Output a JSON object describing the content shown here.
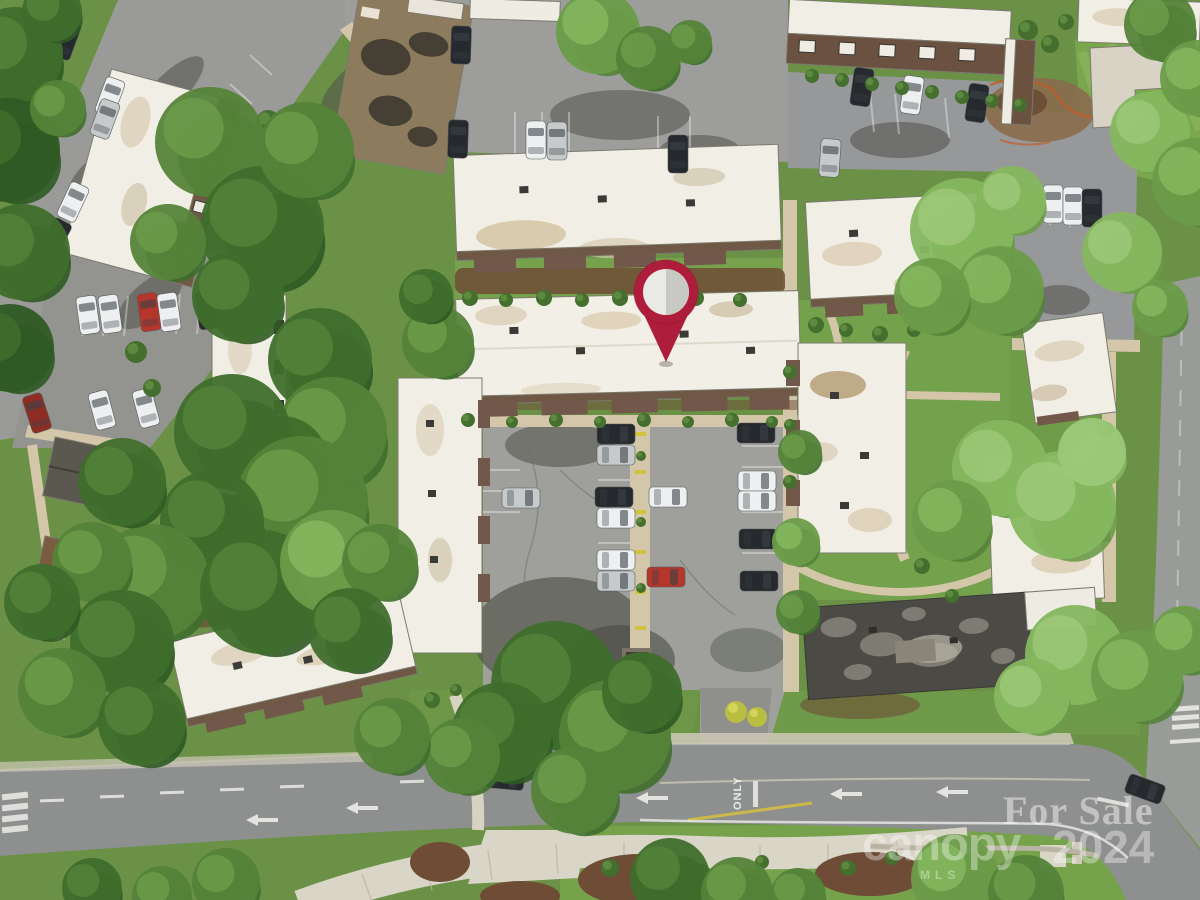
{
  "photo": {
    "type": "aerial-drone-photo",
    "subject": "Aerial view of a condominium complex with white flat-roof buildings, parking lots, mature trees and an access road",
    "season": "spring"
  },
  "marker": {
    "name": "location-pin",
    "color": "#ae1e3c",
    "edge_color": "#8f1630",
    "inner_left_color": "#e9e9e6",
    "inner_right_color": "#c8c9c5"
  },
  "road_markings": {
    "lane_text": "ONLY",
    "paint_color": "#f2f2ee"
  },
  "watermarks": {
    "listing_status": "For Sale",
    "brand": "canopy",
    "brand_sub": "MLS",
    "year": "2024",
    "color": "#ffffff"
  }
}
